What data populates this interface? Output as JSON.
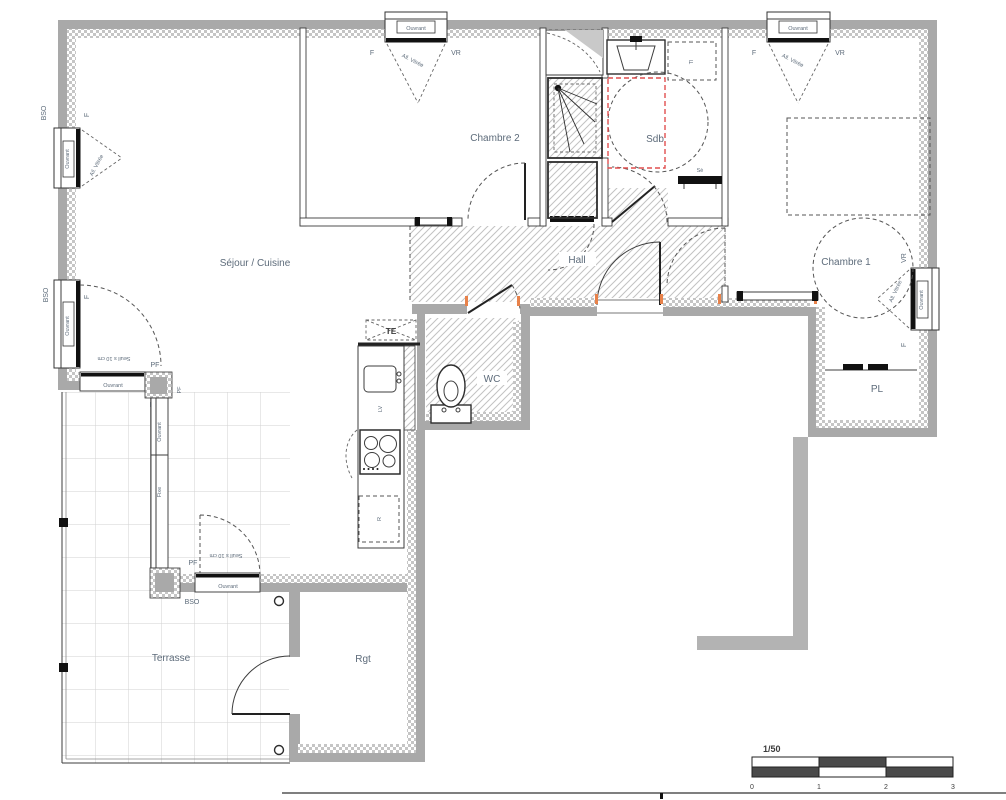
{
  "rooms": {
    "sejour": "Séjour / Cuisine",
    "chambre2": "Chambre 2",
    "chambre1": "Chambre 1",
    "sdb": "Sdb",
    "hall": "Hall",
    "wc": "WC",
    "pl": "PL",
    "terrasse": "Terrasse",
    "rgt": "Rgt"
  },
  "labels": {
    "f": "F",
    "vr": "VR",
    "ouvrant": "Ouvrant",
    "all_vitree": "All. Vitrée",
    "bso": "BSO",
    "pf": "PF",
    "seuil": "Seuil s 10 cm",
    "fixe": "Fixe",
    "te": "TE",
    "lv": "LV",
    "r": "R",
    "se": "Sè",
    "tl": "Tl"
  },
  "scalebar": {
    "ratio": "1/50",
    "ticks": [
      "0",
      "1",
      "2",
      "3"
    ]
  },
  "colors": {
    "wall": "#a9a9a9",
    "line": "#3c3c3c",
    "label": "#5d6b7a",
    "accessibility_red": "#e04f4f",
    "threshold_orange": "#e8824a"
  }
}
